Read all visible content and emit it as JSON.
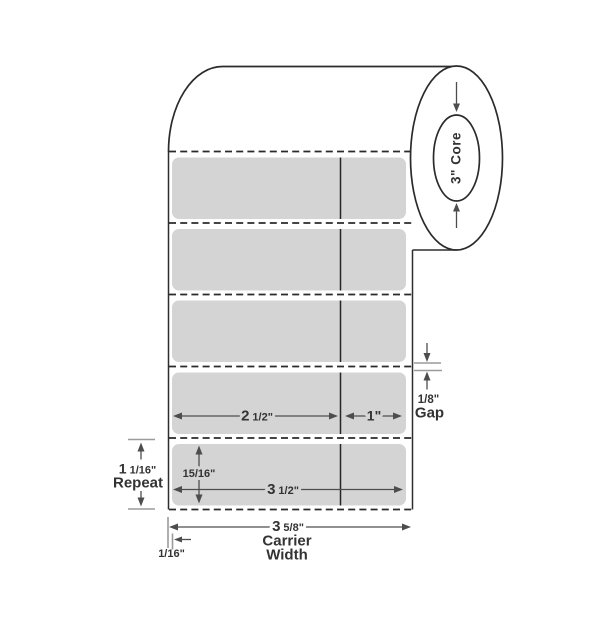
{
  "colors": {
    "background": "#ffffff",
    "label_fill": "#d4d4d4",
    "outline": "#2b2b2b",
    "dimension_line": "#4d4d4d",
    "extension_tick": "#9b9b9b",
    "text": "#333333"
  },
  "roll": {
    "core_label": "3\" Core"
  },
  "dimensions": {
    "left_section_width": {
      "whole": "2",
      "fraction": "1/2\""
    },
    "right_section_width": {
      "value": "1\""
    },
    "gap": {
      "value": "1/8\"",
      "label": "Gap"
    },
    "label_height": {
      "value": "15/16\""
    },
    "label_width": {
      "whole": "3",
      "fraction": "1/2\""
    },
    "repeat": {
      "whole": "1",
      "fraction": "1/16\"",
      "label": "Repeat"
    },
    "carrier_width": {
      "whole": "3",
      "fraction": "5/8\"",
      "word1": "Carrier",
      "word2": "Width"
    },
    "liner_margin": {
      "value": "1/16\""
    }
  }
}
